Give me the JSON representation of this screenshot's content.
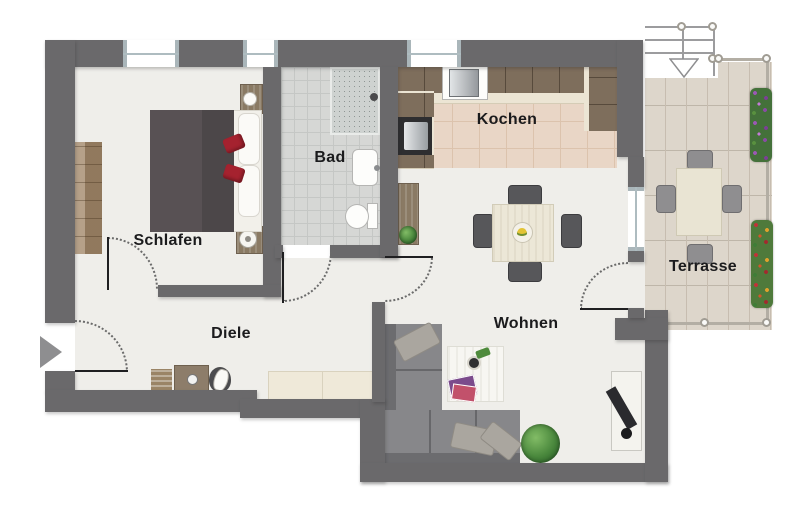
{
  "rooms": {
    "schlafen": "Schlafen",
    "bad": "Bad",
    "kochen": "Kochen",
    "diele": "Diele",
    "wohnen": "Wohnen",
    "terrasse": "Terrasse"
  },
  "icons": {
    "entrance": "right-arrow",
    "terrace_access": "down-arrow"
  },
  "colors": {
    "wall": "#6a696b",
    "floor": "#efeeea",
    "bath_tile": "#d6d7d5",
    "kitchen_tile": "#e9d6c6",
    "terrace_deck": "#ddd6cb",
    "wood": "#a18768",
    "sofa_gray": "#87878a",
    "bed_red_accent": "#a5222f",
    "plant_green": "#49873c",
    "label_text": "#1b1b1d"
  }
}
